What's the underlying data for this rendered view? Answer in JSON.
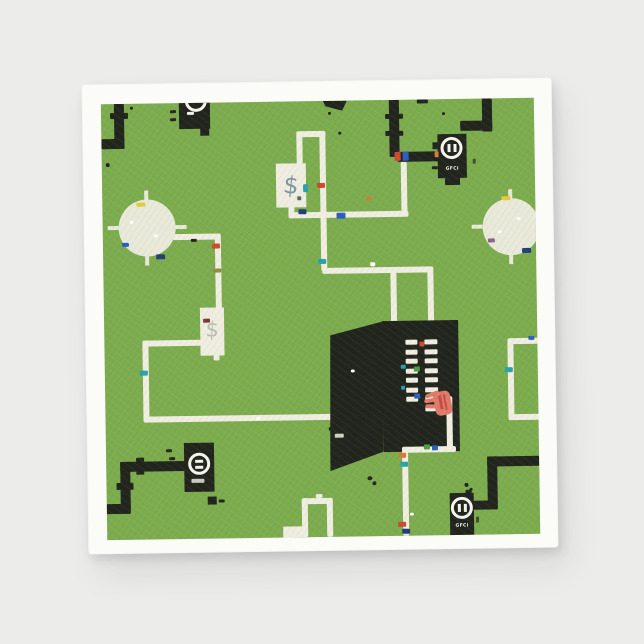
{
  "palette": {
    "bg": "#ecedeb",
    "napkin": "#fbfbf8",
    "green": "#7cac4e",
    "ink": "#21251d",
    "wire": "#f0eee1",
    "light": "#e9e9da",
    "box": "#efede0",
    "dollar_slate": "#7e93a3",
    "dollar_gray": "#b9bdb3",
    "salmon": "#e07a69",
    "salmon_dark": "#c14f44",
    "text_white": "#f6f5ee",
    "nut_red": "#cd4a31",
    "nut_orange": "#d97a36",
    "nut_blue": "#2e5ec1",
    "nut_navy": "#223f7d",
    "nut_teal": "#2ba2ab",
    "nut_green": "#47a23c",
    "nut_yellow": "#e6c93e",
    "nut_purple": "#8a6290",
    "nut_olive": "#8d8c45"
  },
  "print": {
    "labels": {
      "gfci_top_right": "GFCI",
      "gfci_bottom_right": "GFCI",
      "meter_top_center": "$",
      "meter_mid_left": "$"
    },
    "panel": {
      "breakers_left": 7,
      "breakers_right": 8
    }
  },
  "icons": {
    "gfci_outlet": "white ring with two slots",
    "ceiling_light": "pale circle with four tick marks",
    "breaker_switch": "small cream bar",
    "electric_meter": "dollar sign box",
    "hand": "salmon hand reaching into breaker panel"
  }
}
